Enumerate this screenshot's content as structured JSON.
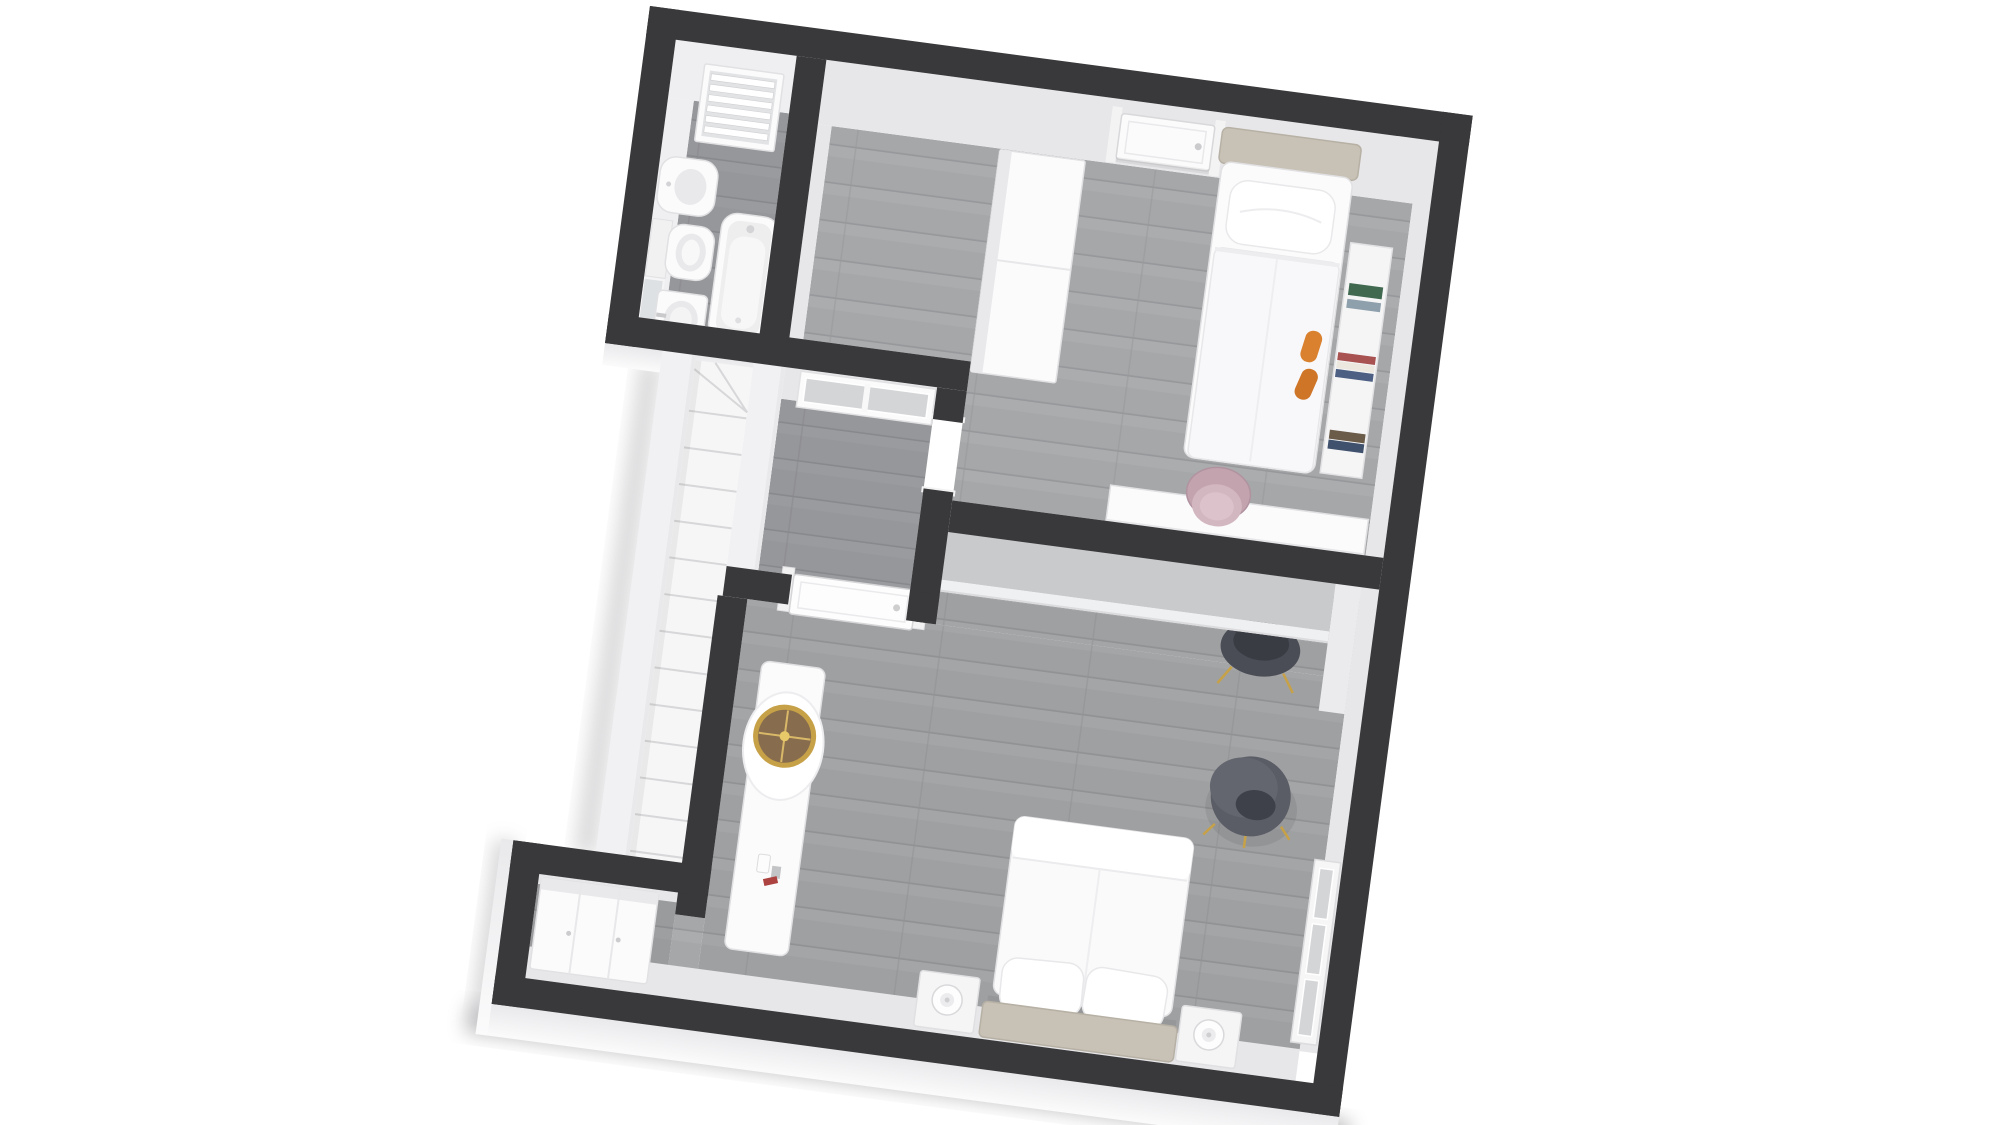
{
  "scene": {
    "type": "3d-floor-plan-render",
    "view": "top-down axonometric, plan rotated about 7.6 degrees clockwise",
    "background": "#ffffff"
  },
  "palette": {
    "wall_dark": "#39393b",
    "wall_face": "#e7e7e9",
    "wall_face_bright": "#efeff1",
    "exterior_face": "#f1f1f3",
    "floor_light": "#a6a7a9",
    "floor_light_line": "#97989b",
    "floor_light_hi": "#b2b3b5",
    "floor_dark": "#96979a",
    "floor_dark_line": "#88898d",
    "furn_white": "#fbfbfc",
    "furn_stroke": "#e1e1e3",
    "furn_shade": "#e9e9eb",
    "headboard": "#c8c1b6",
    "headboard_stroke": "#b7b0a4",
    "pink_chair": "#c2a3ae",
    "pink_chair_light": "#d3b7c0",
    "pink_chair_inner": "#dcc3cb",
    "pouf": "#5a5c66",
    "pouf_hole": "#3e404a",
    "gold": "#c6a148",
    "mirror_glass": "#876c4e",
    "orange_slipper": "#d9812f",
    "orange_slipper2": "#cf7527",
    "lamp_glow": "#f3cf8e",
    "lamp_warm": "#e8b45f",
    "desk_top_gray": "#c9cacc",
    "window_pane": "#d4d5d7",
    "stair_tread": "#f6f6f7",
    "stair_edge": "#d7d7d9",
    "book_green": "#40694f",
    "book_blue": "#4d5f82",
    "book_red": "#a85252",
    "book_navy": "#3f516d",
    "book_brown": "#6b5b49",
    "chair_dark": "#4b4d56"
  },
  "rooms": [
    {
      "id": "bathroom",
      "label": "bathroom",
      "fixtures": [
        "louver-window",
        "bidet",
        "toilet",
        "mirror",
        "sink",
        "bathtub"
      ]
    },
    {
      "id": "hallway",
      "label": "hallway-landing",
      "fixtures": [
        "sliding-window",
        "staircase",
        "doorway-opening"
      ]
    },
    {
      "id": "bedroom-1",
      "label": "single-bedroom",
      "furniture": [
        "entry-door",
        "wall-lamp",
        "wardrobe",
        "single-bed",
        "pillow",
        "shelf-ledge",
        "books",
        "slippers",
        "desk",
        "pink-chair"
      ]
    },
    {
      "id": "bedroom-2",
      "label": "master-bedroom",
      "furniture": [
        "entry-door",
        "vanity-dresser",
        "round-gold-mirror",
        "perfume-bottles",
        "double-bed",
        "pillows",
        "nightstand-left",
        "nightstand-right",
        "table-lamps",
        "long-desk",
        "desk-chair",
        "pouf",
        "tall-window",
        "corner-cabinet"
      ]
    }
  ]
}
